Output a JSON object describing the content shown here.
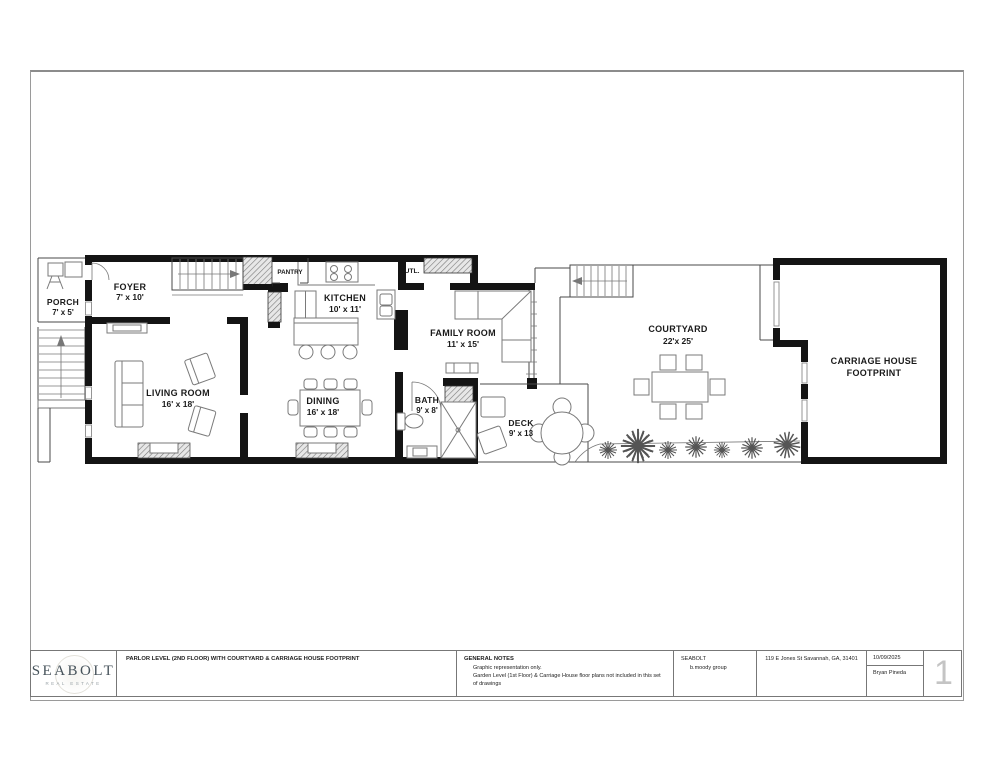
{
  "plan": {
    "rooms": {
      "porch": {
        "name": "PORCH",
        "dims": "7' x 5'"
      },
      "foyer": {
        "name": "FOYER",
        "dims": "7' x 10'"
      },
      "pantry": {
        "name": "PANTRY"
      },
      "kitchen": {
        "name": "KITCHEN",
        "dims": "10' x 11'"
      },
      "utility": {
        "name": "UTL."
      },
      "family_room": {
        "name": "FAMILY ROOM",
        "dims": "11' x 15'"
      },
      "living_room": {
        "name": "LIVING ROOM",
        "dims": "16' x 18'"
      },
      "dining": {
        "name": "DINING",
        "dims": "16' x 18'"
      },
      "bath": {
        "name": "BATH",
        "dims": "9' x 8'"
      },
      "deck": {
        "name": "DECK",
        "dims": "9' x 13"
      },
      "courtyard": {
        "name": "COURTYARD",
        "dims": "22'x 25'"
      },
      "carriage_house": {
        "name": "CARRIAGE HOUSE",
        "dims": "FOOTPRINT"
      }
    }
  },
  "title_block": {
    "logo_name": "SEABOLT",
    "logo_tagline": "REAL ESTATE",
    "drawing_title": "PARLOR LEVEL (2ND FLOOR) WITH COURTYARD & CARRIAGE HOUSE FOOTPRINT",
    "general_notes_heading": "GENERAL NOTES",
    "general_notes": [
      "Graphic representation only.",
      "Garden Level (1st Floor) & Carriage House floor plans not included in this set of drawings"
    ],
    "firm_name": "SEABOLT",
    "firm_group": "b.moody group",
    "address": "119 E Jones St Savannah, GA, 31401",
    "date": "10/09/2025",
    "prepared_by": "Bryan Pineda",
    "sheet_number": "1"
  }
}
